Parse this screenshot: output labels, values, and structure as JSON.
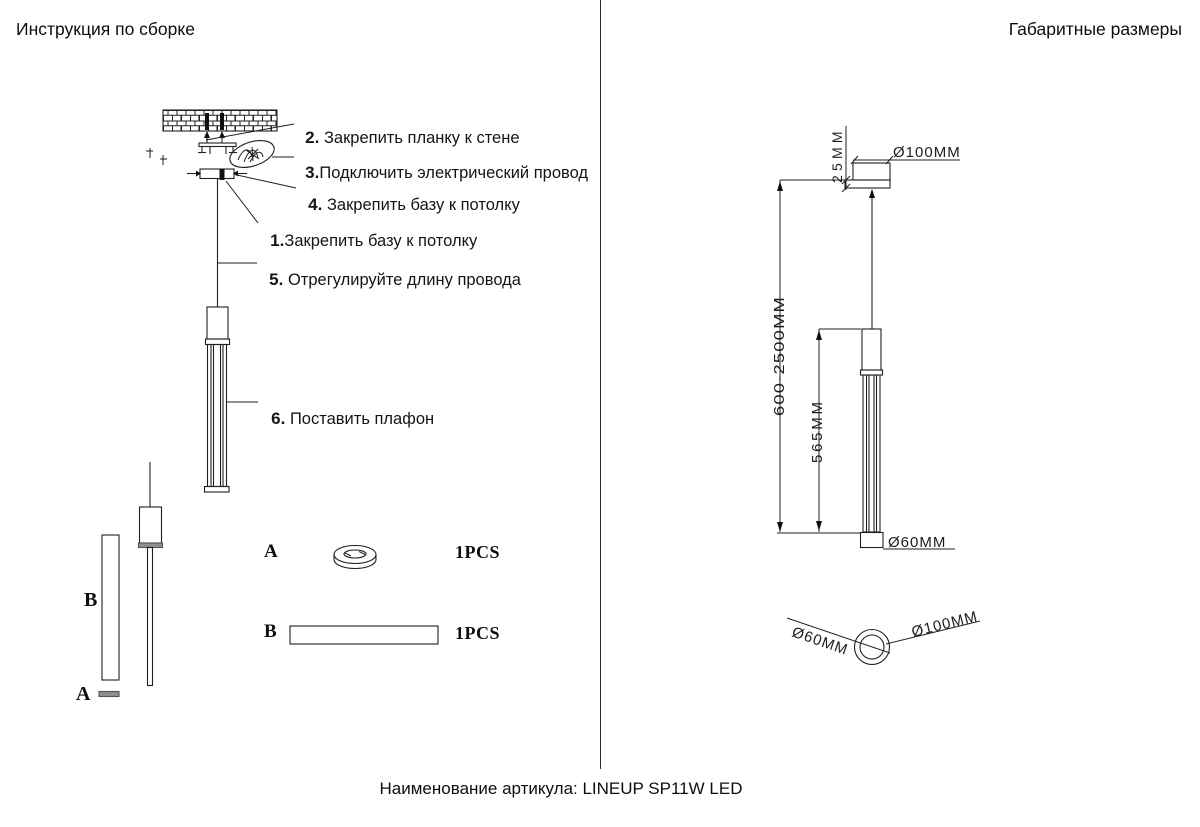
{
  "header": {
    "left_title": "Инструкция по сборке",
    "right_title": "Габаритные размеры"
  },
  "assembly": {
    "steps": [
      {
        "num": "2.",
        "text": " Закрепить планку к стене"
      },
      {
        "num": "3.",
        "text": "Подключить электрический провод"
      },
      {
        "num": "4.",
        "text": " Закрепить базу к потолку"
      },
      {
        "num": "1.",
        "text": "Закрепить базу к потолку"
      },
      {
        "num": "5.",
        "text": " Отрегулируйте длину провода"
      },
      {
        "num": "6.",
        "text": " Поставить плафон"
      }
    ],
    "component_labels": {
      "bar": "B",
      "plate": "A"
    },
    "parts": [
      {
        "letter": "A",
        "qty": "1PCS"
      },
      {
        "letter": "B",
        "qty": "1PCS"
      }
    ]
  },
  "dimensions": {
    "canopy_height": "25MM",
    "canopy_diameter_top": "Ø100MM",
    "suspension_range": "600-2500MM",
    "shade_height": "565MM",
    "shade_diameter": "Ø60MM",
    "bottom_view_shade": "Ø60MM",
    "bottom_view_canopy": "Ø100MM"
  },
  "footer": {
    "article": "Наименование артикула: LINEUP SP11W LED"
  }
}
